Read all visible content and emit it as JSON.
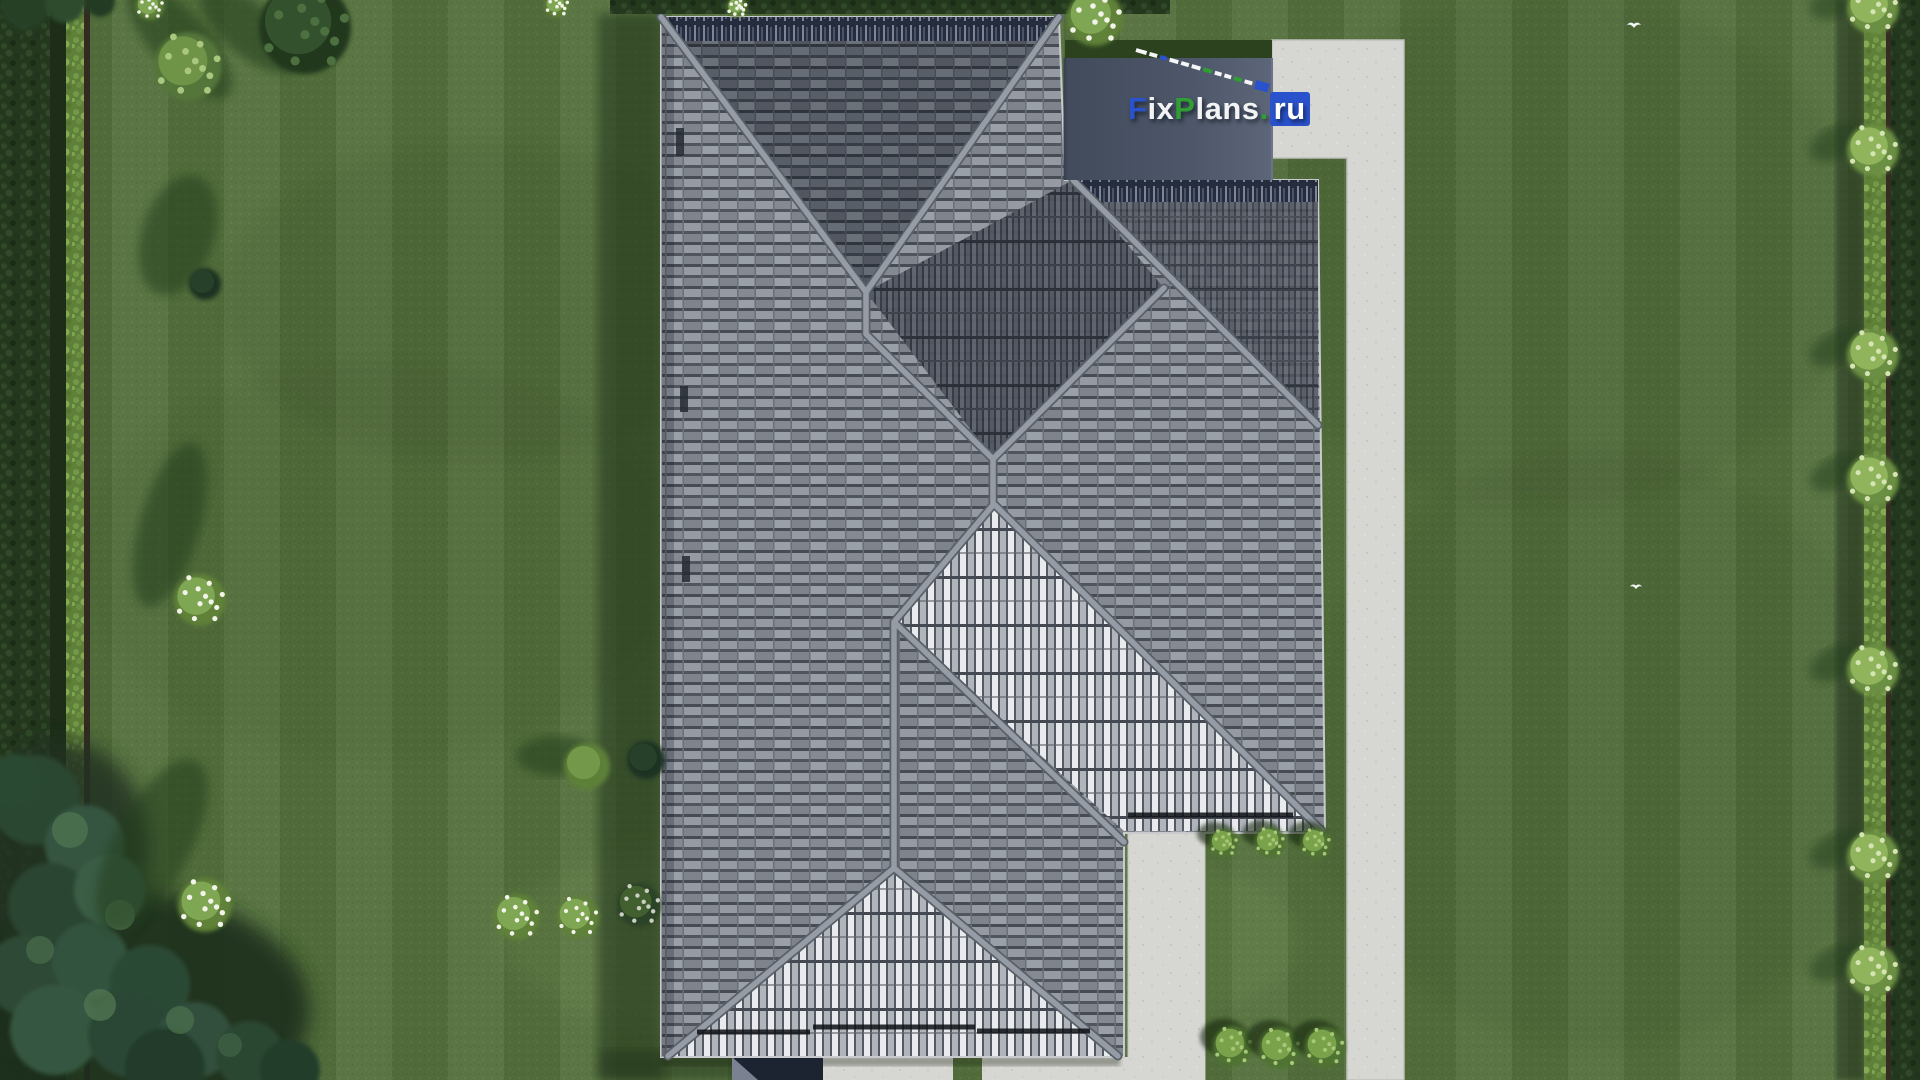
{
  "watermark": {
    "full_text": "FixPlans.ru",
    "parts": [
      {
        "text": "F",
        "color": "#2a52cc"
      },
      {
        "text": "ix",
        "color": "#f2f3f5"
      },
      {
        "text": "P",
        "color": "#2f9e33"
      },
      {
        "text": "lans",
        "color": "#f2f3f5"
      },
      {
        "text": ".",
        "color": "#2f9e33"
      },
      {
        "text": "ru",
        "color": "#ffffff",
        "badge": "#2a52cc"
      }
    ]
  },
  "scalebar": {
    "x1": 1136,
    "y1": 50,
    "x2": 1268,
    "y2": 88,
    "gap": 3,
    "thickness": 4,
    "dashes": [
      {
        "len": 11,
        "c": "#f5f6f7"
      },
      {
        "len": 8,
        "c": "#f5f6f7"
      },
      {
        "len": 7,
        "c": "#2a52cc"
      },
      {
        "len": 9,
        "c": "#f5f6f7"
      },
      {
        "len": 8,
        "c": "#f5f6f7"
      },
      {
        "len": 9,
        "c": "#f5f6f7"
      },
      {
        "len": 9,
        "c": "#2f9e33"
      },
      {
        "len": 7,
        "c": "#f5f6f7"
      },
      {
        "len": 7,
        "c": "#f5f6f7"
      },
      {
        "len": 8,
        "c": "#2f9e33"
      },
      {
        "len": 8,
        "c": "#f5f6f7"
      },
      {
        "len": 14,
        "c": "#2a52cc",
        "thick": 9
      }
    ]
  },
  "palette": {
    "lawn": "#55713d",
    "lawn_shadow": "#233c1e",
    "roof_tile_mid": "#8d929a",
    "roof_tile_dark": "#61666f",
    "roof_stripe_bright": "#e8eaed",
    "roof_stripe_dark": "#4a4f59",
    "roof_ridge": "#969ca6",
    "roof_eave_navy": "#242c3d",
    "flat_roof_left": "#414b5c",
    "flat_roof_right": "#5c6678",
    "concrete": "#d6d6d3",
    "hedge_dark": "#24381e",
    "hedge_light": "#5f8038",
    "garage_wall": "#1c2431",
    "gutter": "#0e1116",
    "bird": "#f4f6f4"
  },
  "roof": {
    "vents": [
      {
        "x": 676,
        "y": 128,
        "w": 8,
        "h": 28
      },
      {
        "x": 680,
        "y": 386,
        "w": 8,
        "h": 26
      },
      {
        "x": 682,
        "y": 556,
        "w": 8,
        "h": 26
      }
    ],
    "gutters": [
      {
        "x1": 697,
        "y1": 1032,
        "x2": 810,
        "y2": 1032
      },
      {
        "x1": 813,
        "y1": 1027,
        "x2": 975,
        "y2": 1027
      },
      {
        "x1": 977,
        "y1": 1031,
        "x2": 1090,
        "y2": 1031
      },
      {
        "x1": 1128,
        "y1": 815,
        "x2": 1293,
        "y2": 815
      }
    ]
  },
  "garden": {
    "right_hedge_bushes": [
      {
        "y": 8
      },
      {
        "y": 150
      },
      {
        "y": 355
      },
      {
        "y": 480
      },
      {
        "y": 670
      },
      {
        "y": 857
      },
      {
        "y": 970
      }
    ],
    "inset_bushes_top": [
      {
        "x": 1224,
        "y": 843,
        "r": 14
      },
      {
        "x": 1270,
        "y": 842,
        "r": 15
      },
      {
        "x": 1316,
        "y": 843,
        "r": 15
      }
    ],
    "inset_bushes_bottom": [
      {
        "x": 1233,
        "y": 1046,
        "r": 20
      },
      {
        "x": 1280,
        "y": 1048,
        "r": 21
      },
      {
        "x": 1325,
        "y": 1047,
        "r": 20
      }
    ],
    "lawn_features": [
      {
        "type": "shadow",
        "x": 180,
        "y": 42,
        "rx": 72,
        "ry": 28,
        "rot": 48
      },
      {
        "type": "shadow",
        "x": 250,
        "y": 30,
        "rx": 60,
        "ry": 26,
        "rot": 40
      },
      {
        "type": "tree",
        "x": 188,
        "y": 66,
        "r": 34
      },
      {
        "type": "tree-dark",
        "x": 305,
        "y": 28,
        "r": 46
      },
      {
        "type": "shadow",
        "x": 178,
        "y": 235,
        "rx": 36,
        "ry": 62,
        "rot": 18
      },
      {
        "type": "bush-dark",
        "x": 205,
        "y": 284,
        "r": 16
      },
      {
        "type": "shadow",
        "x": 170,
        "y": 525,
        "rx": 30,
        "ry": 85,
        "rot": 16
      },
      {
        "type": "flower",
        "x": 200,
        "y": 600,
        "r": 26
      },
      {
        "type": "shadow",
        "x": 152,
        "y": 845,
        "rx": 38,
        "ry": 95,
        "rot": 28
      },
      {
        "type": "flower",
        "x": 205,
        "y": 905,
        "r": 27
      },
      {
        "type": "shadow",
        "x": 556,
        "y": 756,
        "rx": 40,
        "ry": 20,
        "rot": 0
      },
      {
        "type": "bush",
        "x": 587,
        "y": 766,
        "r": 23
      },
      {
        "type": "bush-dark",
        "x": 646,
        "y": 760,
        "r": 19
      },
      {
        "type": "flower",
        "x": 517,
        "y": 917,
        "r": 23
      },
      {
        "type": "flower",
        "x": 578,
        "y": 917,
        "r": 21
      },
      {
        "type": "flower-dark",
        "x": 639,
        "y": 905,
        "r": 22
      },
      {
        "type": "flower",
        "x": 150,
        "y": 6,
        "r": 14
      },
      {
        "type": "flower",
        "x": 557,
        "y": 5,
        "r": 12
      },
      {
        "type": "flower",
        "x": 737,
        "y": 7,
        "r": 10
      },
      {
        "type": "flower",
        "x": 1095,
        "y": 18,
        "r": 28
      }
    ]
  },
  "birds": [
    {
      "x": 1627,
      "y": 22,
      "s": 1.0
    },
    {
      "x": 1630,
      "y": 584,
      "s": 0.85
    }
  ]
}
